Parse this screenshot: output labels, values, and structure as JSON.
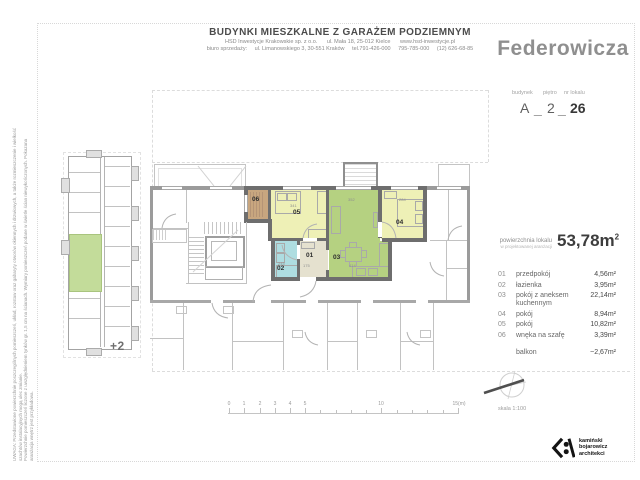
{
  "header": {
    "title": "BUDYNKI MIESZKALNE Z GARAŻEM PODZIEMNYM",
    "line2": [
      "HSD Inwestycje Krakowskie sp. z o.o.",
      "ul. Mała 18, 25-012 Kielce",
      "www.hsd-inwestycje.pl"
    ],
    "line3": [
      "biuro sprzedaży:",
      "ul. Limanowskiego 3, 30-551 Kraków",
      "tel.791-426-000",
      "795-785-000",
      "(12) 626-68-85"
    ]
  },
  "brand": {
    "name": "Federowicza"
  },
  "unit": {
    "labels": [
      "budynek",
      "piętro",
      "nr lokalu"
    ],
    "building": "A",
    "sep1": "_",
    "floor": "2",
    "sep2": "_",
    "number": "26"
  },
  "area": {
    "label": "powierzchnia lokalu",
    "sublabel": "w projektowanej aranżacji",
    "value": "53,78m",
    "value_sup": "2"
  },
  "rooms": [
    {
      "no": "01",
      "name": "przedpokój",
      "area": "4,56m²"
    },
    {
      "no": "02",
      "name": "łazienka",
      "area": "3,95m²"
    },
    {
      "no": "03",
      "name": "pokój z aneksem kuchennym",
      "area": "22,14m²"
    },
    {
      "no": "04",
      "name": "pokój",
      "area": "8,94m²"
    },
    {
      "no": "05",
      "name": "pokój",
      "area": "10,82m²"
    },
    {
      "no": "06",
      "name": "wnęka na szafę",
      "area": "3,39m²"
    }
  ],
  "balcony": {
    "name": "balkon",
    "area": "~2,67m²"
  },
  "siteplan": {
    "floor_label": "+2"
  },
  "plan": {
    "labels": {
      "r01": "01",
      "r02": "02",
      "r03": "03",
      "r04": "04",
      "r05": "05",
      "r06": "06"
    },
    "dims": {
      "d05": "341",
      "d03_top": "352",
      "d04": "284",
      "d03_bottom": "414",
      "d01": "175",
      "d02": "245"
    }
  },
  "scalebar": {
    "labels": [
      "0",
      "1",
      "2",
      "3",
      "4",
      "5",
      "10",
      "15(m)"
    ]
  },
  "footer": {
    "scale_label": "skala 1:100"
  },
  "logo": {
    "line1": "kamiński",
    "line2": "bojarowicz",
    "line3": "architekci"
  },
  "disclaimer": {
    "line1": "UWAGA: Przedstawione powierzchnie poszczególnych pomieszczeń, układ, rozstaw oraz gabaryty otworów okiennych i drzwiowych, a także rozmieszczenie i wielkość szachtów instalacyjnych mogą ulec zmianie.",
    "line2": "Powierzchnie pomieszczeń liczone z uwzględnieniem tynków gr. 1,5 cm na ścianach. Wymiary pomieszczeń podane w świetle ścian niewykończonych. Pokazana aranżacja wnętrz jest przykładowa."
  },
  "colors": {
    "wall_dark": "#6e6e6e",
    "room_living": "#b5d181",
    "room_bedroom": "#eef0b6",
    "room_wardrobe": "#c8a67f",
    "room_bath": "#aedde1",
    "room_hall": "#e5e1cf",
    "siteplan_highlight": "#c3dc9a",
    "brand_gray": "#8f8f8f"
  }
}
